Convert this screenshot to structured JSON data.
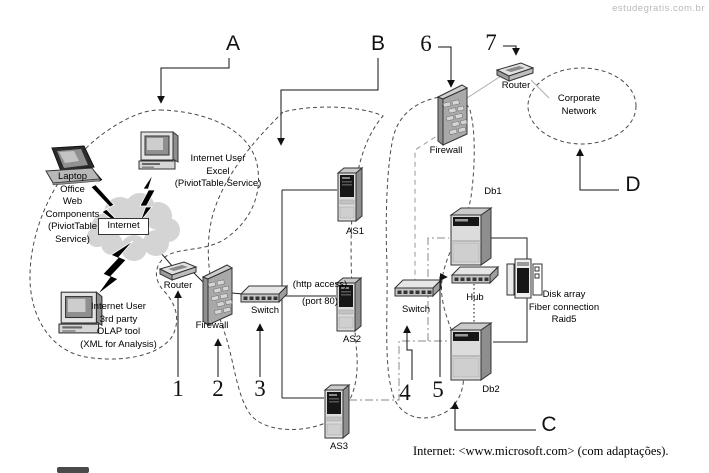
{
  "watermark": "estudegratis.com.br",
  "caption": "Internet: <www.microsoft.com> (com adaptações).",
  "callout_letters": {
    "a": "A",
    "b": "B",
    "c": "C",
    "d": "D"
  },
  "callout_numbers": {
    "n1": "1",
    "n2": "2",
    "n3": "3",
    "n4": "4",
    "n5": "5",
    "n6": "6",
    "n7": "7"
  },
  "labels": {
    "laptop": "Laptop\nOffice\nWeb\nComponents\n(PiviotTable\nService)",
    "excel_user": "Internet User\nExcel\n(PiviotTable Service)",
    "olap_user": "Internet User\n3rd party\nOLAP tool\n(XML for Analysis)",
    "internet": "Internet",
    "router_edge": "Router",
    "firewall_front": "Firewall",
    "switch_front": "Switch",
    "http_access": "(http access)",
    "port_80": "(port 80)",
    "as1": "AS1",
    "as2": "AS2",
    "as3": "AS3",
    "firewall_back": "Firewall",
    "router_corp": "Router",
    "switch_back": "Switch",
    "hub": "Hub",
    "db1": "Db1",
    "db2": "Db2",
    "disk_array": "Disk array\nFiber connection\nRaid5",
    "corporate_network": "Corporate\nNetwork"
  },
  "colors": {
    "ink": "#222222",
    "dash": "#4a4a4a",
    "gray_line": "#aaaaaa",
    "watermark": "#b9b9b9"
  }
}
